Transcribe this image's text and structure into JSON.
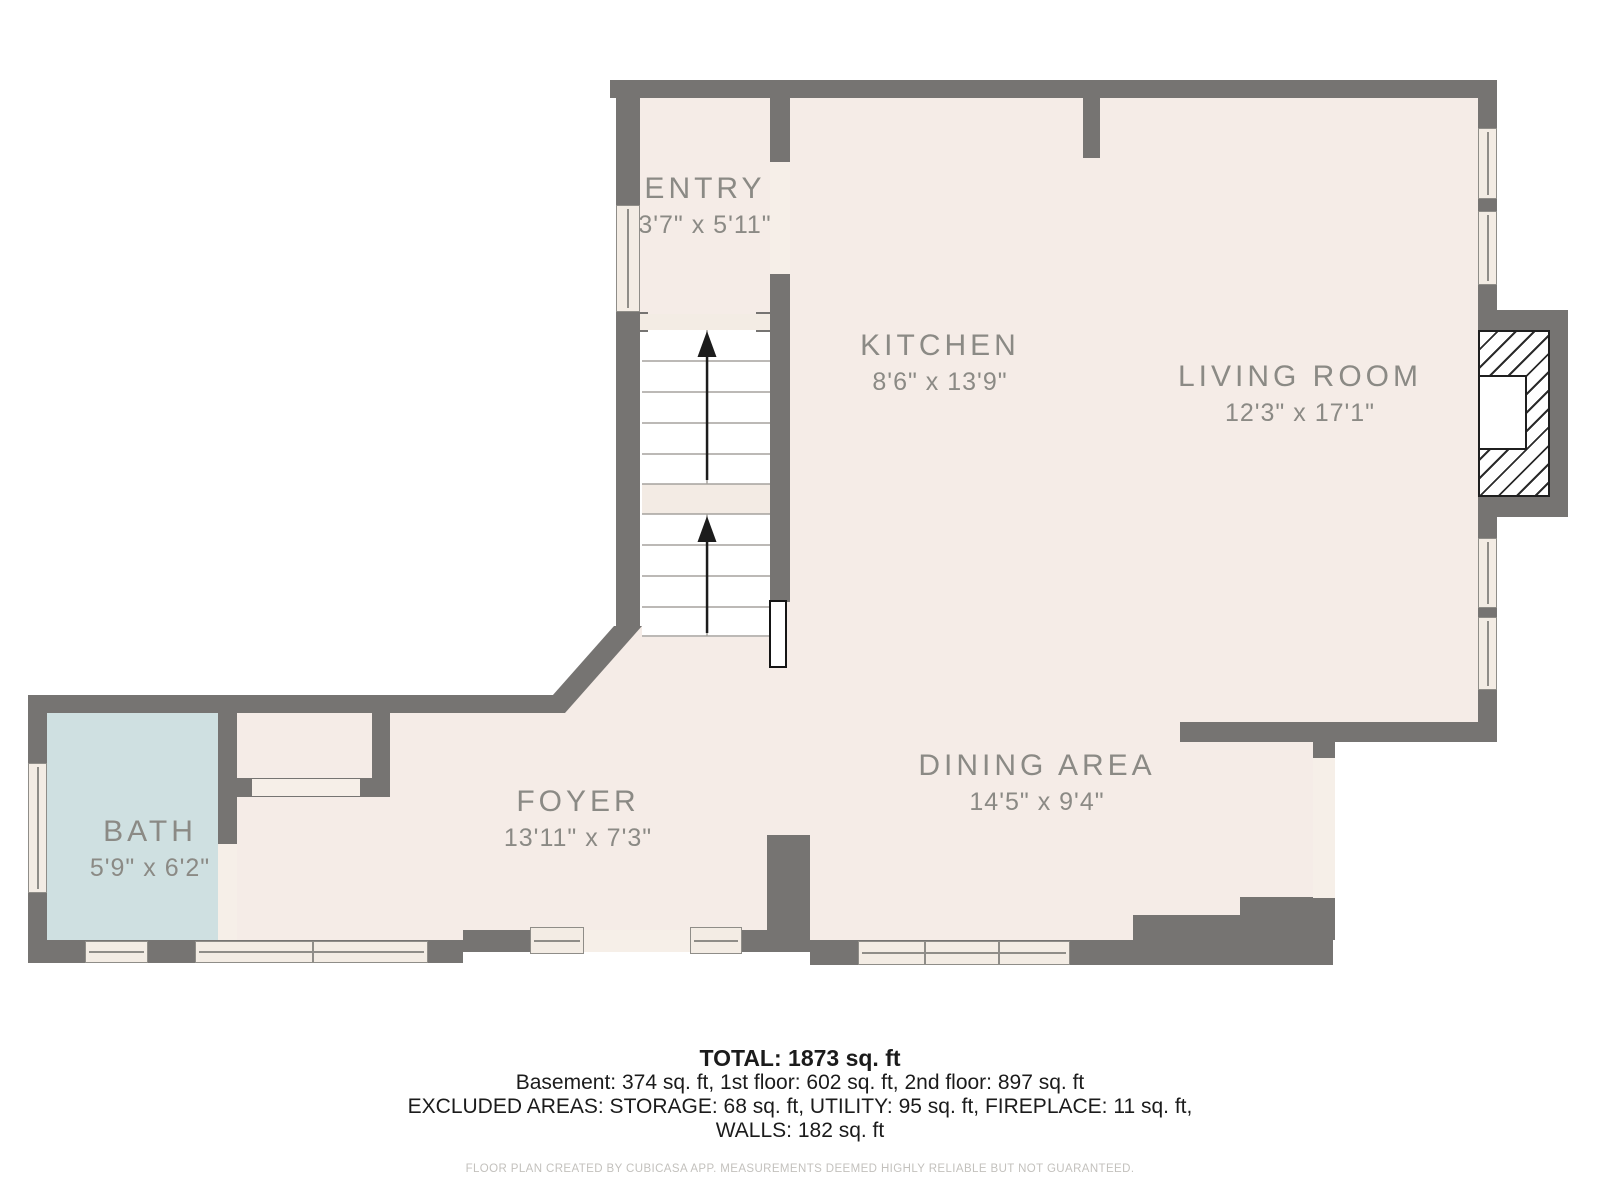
{
  "rooms": [
    {
      "name": "ENTRY",
      "dims": "3'7\" x 5'11\""
    },
    {
      "name": "KITCHEN",
      "dims": "8'6\" x 13'9\""
    },
    {
      "name": "LIVING ROOM",
      "dims": "12'3\" x 17'1\""
    },
    {
      "name": "DINING AREA",
      "dims": "14'5\" x 9'4\""
    },
    {
      "name": "FOYER",
      "dims": "13'11\" x 7'3\""
    },
    {
      "name": "BATH",
      "dims": "5'9\" x 6'2\""
    }
  ],
  "summary": {
    "total": "TOTAL: 1873 sq. ft",
    "floors": "Basement: 374 sq. ft, 1st floor: 602 sq. ft, 2nd floor: 897 sq. ft",
    "excluded": "EXCLUDED AREAS: STORAGE: 68 sq. ft, UTILITY: 95 sq. ft, FIREPLACE: 11 sq. ft,",
    "walls": "WALLS: 182 sq. ft",
    "footer": "FLOOR PLAN CREATED BY CUBICASA APP. MEASUREMENTS DEEMED HIGHLY RELIABLE BUT NOT GUARANTEED."
  },
  "colors": {
    "wall": "#767472",
    "floor": "#f5ece7",
    "bath_floor": "#cfe0e1",
    "window_fill": "#f3ece4",
    "label_text": "#8b8a85",
    "footer_text": "#c3c1bd",
    "outline_black": "#1f1f1f"
  }
}
